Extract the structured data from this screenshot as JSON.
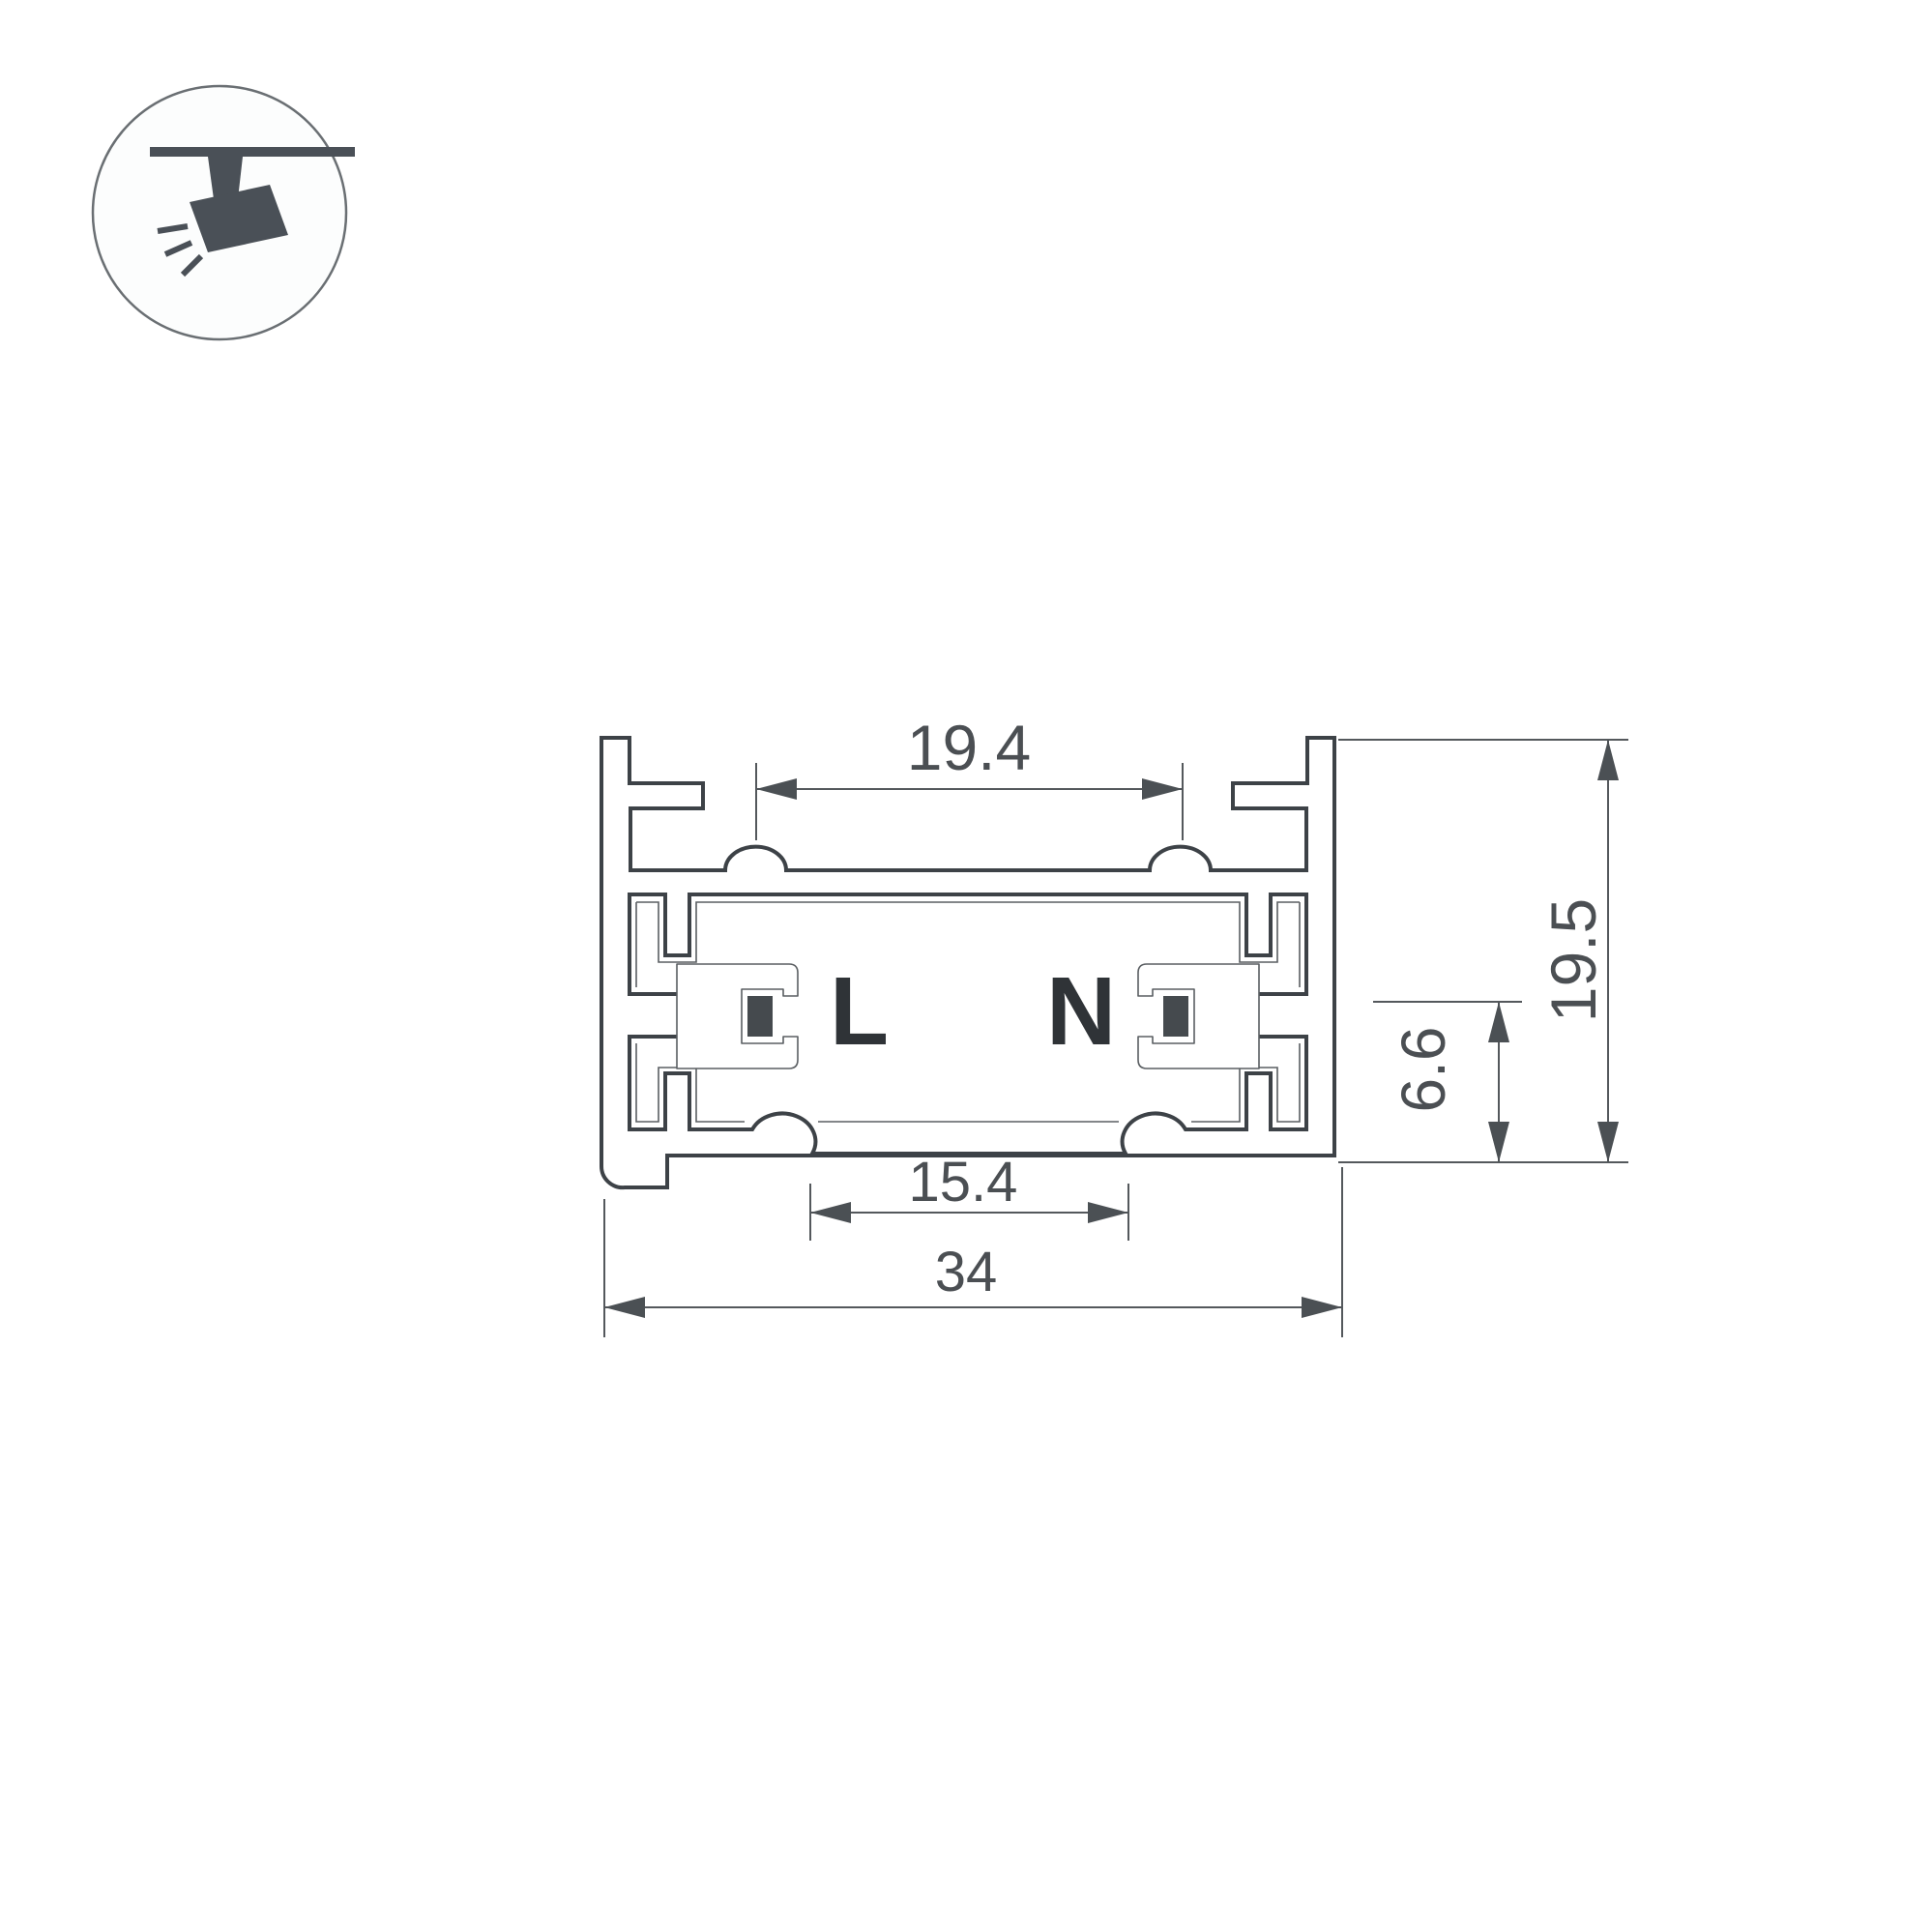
{
  "icon_badge": {
    "name": "ceiling-track-spotlight-pictogram",
    "shape": "circle-outline",
    "color": "#4a5057"
  },
  "diagram": {
    "kind": "technical-cross-section",
    "subject": "track-profile",
    "labels": {
      "live": "L",
      "neutral": "N"
    },
    "dimensions": {
      "top_channel_width": "19.4",
      "bottom_opening_width": "15.4",
      "overall_width": "34",
      "overall_height": "19.5",
      "conductor_height": "6.6"
    },
    "colors": {
      "profile_outline": "#3d4247",
      "thin_liner_line": "#5a5e62",
      "dimension_line": "#54585c",
      "dimension_text": "#4b4f53",
      "conductor_fill": "#454a4e",
      "label_text": "#2f3337",
      "background": "#ffffff"
    }
  }
}
